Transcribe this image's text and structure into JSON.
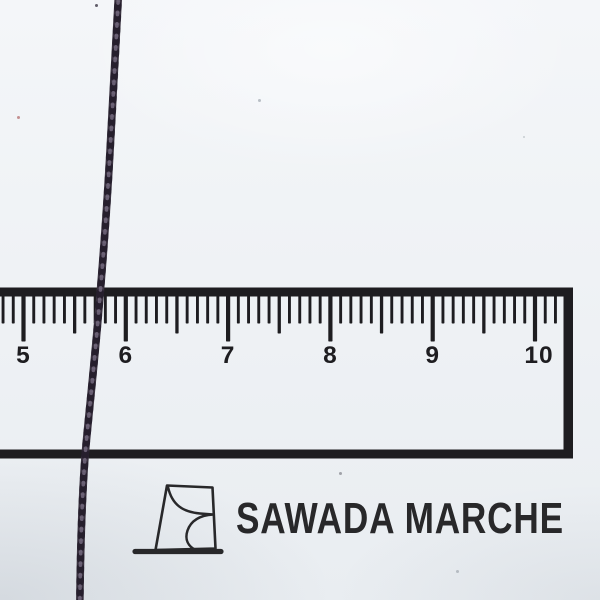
{
  "photo": {
    "background_color": "#eff2f5"
  },
  "ruler": {
    "color": "#1e1d20",
    "unit_labels": [
      "5",
      "6",
      "7",
      "8",
      "9",
      "10"
    ]
  },
  "thread": {
    "color": "#3a3240",
    "shadow_color": "#16111d",
    "highlight_color": "#8b7f96"
  },
  "brand": {
    "name": "SAWADA MARCHE",
    "logo_icon": "sawada-marche-logo-mark",
    "text_color": "#28282a"
  }
}
